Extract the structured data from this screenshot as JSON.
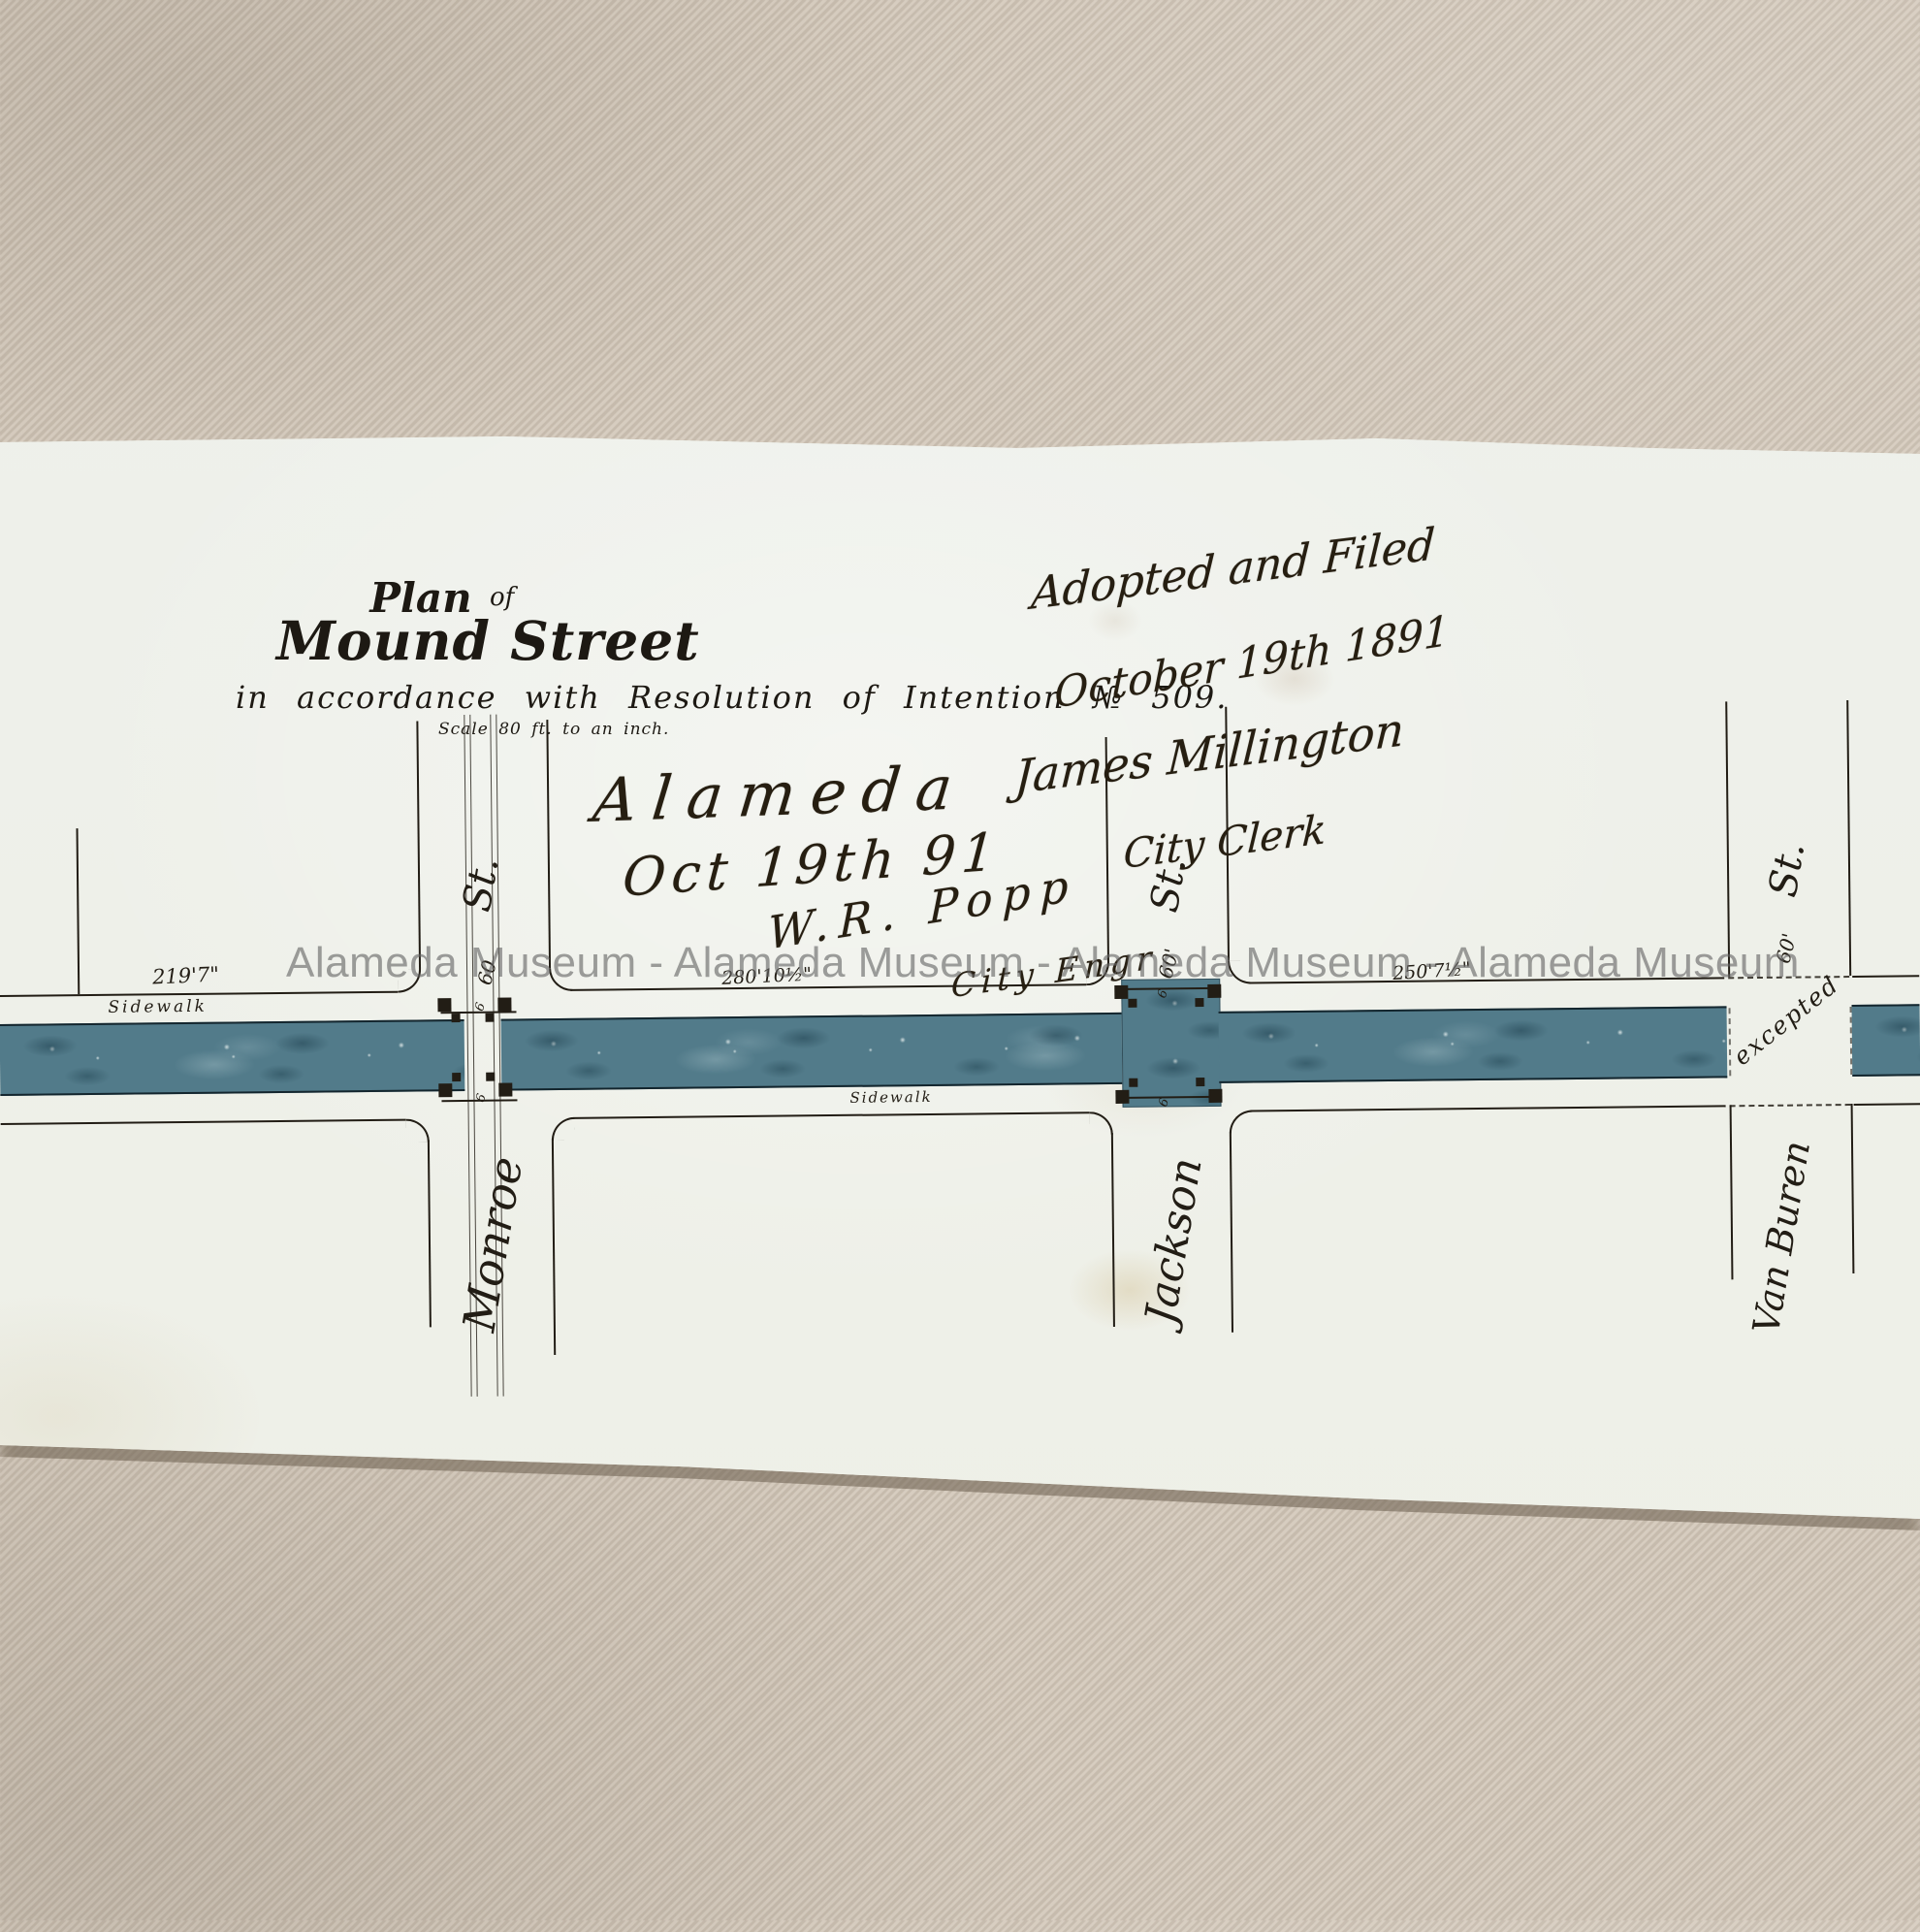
{
  "watermark": "Alameda Museum - Alameda Museum - Alameda Museum - Alameda Museum",
  "title_block": {
    "plan": "Plan",
    "of": "of",
    "street": "Mound Street",
    "subtitle": "in accordance with Resolution of Intention № 509.",
    "scale": "Scale 80 ft. to an inch."
  },
  "engineer_note": {
    "place": "Alameda",
    "date": "Oct 19th 91",
    "signature": "W.R. Popp",
    "title": "City Engr"
  },
  "clerk_note": {
    "line1": "Adopted and Filed",
    "line2": "October 19th 1891",
    "signature": "James Millington",
    "title": "City Clerk"
  },
  "plan": {
    "cross_streets": [
      {
        "name": "Monroe",
        "suffix": "St.",
        "width": "60"
      },
      {
        "name": "Jackson",
        "suffix": "St.",
        "width": "60'"
      },
      {
        "name": "Van Buren",
        "suffix": "St.",
        "width": "60'"
      }
    ],
    "exception_note": "excepted",
    "measurements": {
      "block1": "219'7\"",
      "block2": "280'10½\"",
      "block3": "250'7½\""
    },
    "sidewalk_upper": "Sidewalk",
    "sidewalk_lower": "Sidewalk",
    "curb_marks": [
      "6",
      "6",
      "6",
      "6"
    ],
    "colors": {
      "roadway": "#527b8a",
      "ink": "#221d15",
      "paper": "#eff1ea",
      "fabric": "#ccc2b4",
      "watermark": "#646464"
    }
  }
}
